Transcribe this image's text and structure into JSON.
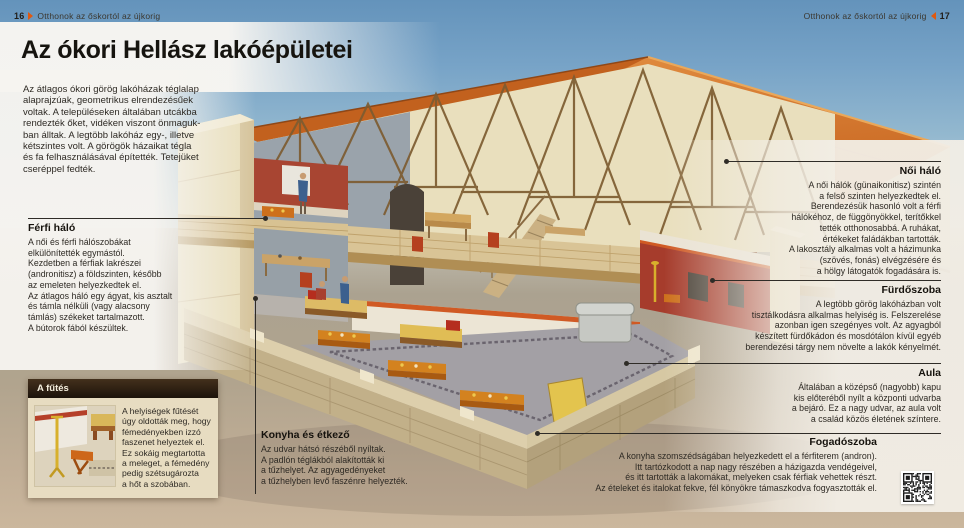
{
  "header": {
    "left": {
      "page": "16",
      "title": "Otthonok az őskortól az újkorig"
    },
    "right": {
      "title": "Otthonok az őskortól az újkorig",
      "page": "17"
    }
  },
  "page_title": "Az ókori Hellász lakóépületei",
  "intro": "Az átlagos ókori görög lakóházak téglalap\nalaprajzúak, geometrikus elrendezésűek\nvoltak. A településeken általában utcákba\nrendezték őket, vidéken viszont önmaguk-\nban álltak. A legtöbb lakóház egy-, illetve\nkétszintes volt. A görögök házaikat tégla\nés fa felhasználásával építették. Tetejüket\ncseréppel fedték.",
  "annotations": {
    "ferfi_halo": {
      "title": "Férfi háló",
      "body": "A női és férfi hálószobákat\nelkülönítették egymástól.\nKezdetben a férfiak lakrészei\n(andronitisz) a földszinten, később\naz emeleten helyezkedtek el.\nAz átlagos háló egy ágyat, kis asztalt\nés támla nélküli (vagy alacsony\ntámlás) székeket tartalmazott.\nA bútorok fából készültek."
    },
    "futes": {
      "title": "A fűtés",
      "body": "A helyiségek fűtését\núgy oldották meg, hogy\nfémedényekben izzó\nfaszenet helyeztek el.\nEz sokáig megtartotta\na meleget, a fémedény\npedig szétsugározta\na hőt a szobában."
    },
    "konyha": {
      "title": "Konyha és étkező",
      "body": "Az udvar hátsó részéből nyíltak.\nA padlón téglákból alakították ki\na tűzhelyet. Az agyagedényeket\na tűzhelyben levő faszénre helyezték."
    },
    "noi_halo": {
      "title": "Női háló",
      "body": "A női hálók (günaikonitisz) szintén\na felső szinten helyezkedtek el.\nBerendezésük hasonló volt a férfi\nhálókéhoz, de függönyökkel, terítőkkel\ntették otthonosabbá. A ruhákat,\nértékeket faládákban tartották.\nA lakosztály alkalmas volt a házimunka\n(szövés, fonás) elvégzésére és\na hölgy látogatók fogadására is."
    },
    "furdoszoba": {
      "title": "Fürdőszoba",
      "body": "A legtöbb görög lakóházban volt\ntisztálkodásra alkalmas helyiség is. Felszerelése\nazonban igen szegényes volt. Az agyagból\nkészített fürdőkádon és mosdótálon kívül egyéb\nberendezési tárgy nem növelte a lakók kényelmét."
    },
    "aula": {
      "title": "Aula",
      "body": "Általában a középső (nagyobb) kapu\nkis előteréből nyílt a központi udvarba\na bejáró. Ez a nagy udvar, az aula volt\na család közös életének színtere."
    },
    "fogadoszoba": {
      "title": "Fogadószoba",
      "body": "A konyha szomszédságában helyezkedett el a férfiterem (andron).\nItt tartózkodott a nap nagy részében a házigazda vendégeivel,\nés itt tartották a lakomákat, melyeken csak férfiak vehettek részt.\nAz ételeket és italokat fekve, fél könyökre támaszkodva fogyasztották el."
    }
  },
  "icons": {
    "arrow_right": "right-pointing page arrow",
    "arrow_left": "left-pointing page arrow",
    "qr_code": "qr-code"
  },
  "colors": {
    "accent_orange": "#e0590f",
    "leader_line": "#2f2c27",
    "box_header_bg": "#1c130b",
    "box_body_bg": "#e7dcc1",
    "roof_tile": "#cf6c24",
    "red_wall": "#a63c2c"
  }
}
